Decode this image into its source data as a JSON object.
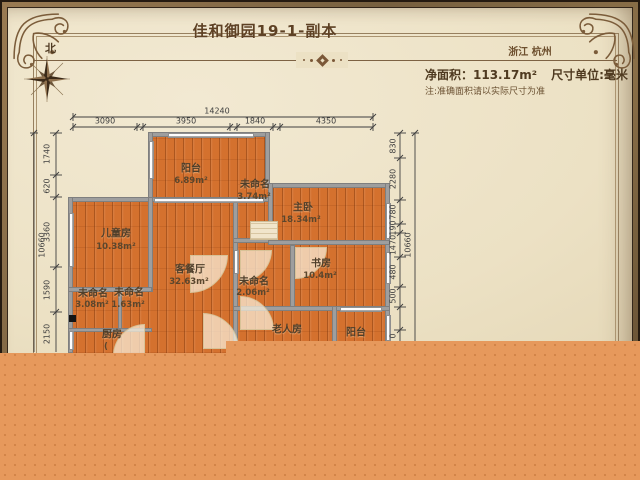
{
  "header": {
    "title": "佳和御园19-1-副本",
    "location": "浙江 杭州",
    "net_area_label": "净面积：113.17m²",
    "unit_label": "尺寸单位:毫米",
    "note": "注:准确面积请以实际尺寸为准",
    "compass_north": "北"
  },
  "dimensions": {
    "top_total": "14240",
    "top_segments": [
      "3090",
      "3950",
      "1840",
      "4350"
    ],
    "left_total": "10660",
    "left_segments": [
      "1740",
      "620",
      "3360",
      "1590",
      "2150"
    ],
    "right_total": "10660",
    "right_segments": [
      "830",
      "2280",
      "780",
      "190",
      "1470",
      "480",
      "500"
    ],
    "right_partial": "0"
  },
  "rooms": [
    {
      "name": "阳台",
      "area": "6.89m²"
    },
    {
      "name": "未命名",
      "area": "3.74m²"
    },
    {
      "name": "主卧",
      "area": "18.34m²"
    },
    {
      "name": "儿童房",
      "area": "10.38m²"
    },
    {
      "name": "客餐厅",
      "area": "32.63m²"
    },
    {
      "name": "未命名",
      "area": "2.06m²"
    },
    {
      "name": "书房",
      "area": "10.4m²"
    },
    {
      "name": "未命名",
      "area": "3.08m²"
    },
    {
      "name": "未命名",
      "area": "1.63m²"
    },
    {
      "name": "厨房",
      "area": "("
    },
    {
      "name": "老人房",
      "area": ""
    },
    {
      "name": "阳台",
      "area": ""
    }
  ],
  "colors": {
    "parchment": "#ece1c4",
    "border_brown": "#77603f",
    "title_brown": "#5e4124",
    "wall_gray": "#9e9e9e",
    "floor_orange": "#d4712e",
    "overlay_orange": "#e6995c"
  }
}
